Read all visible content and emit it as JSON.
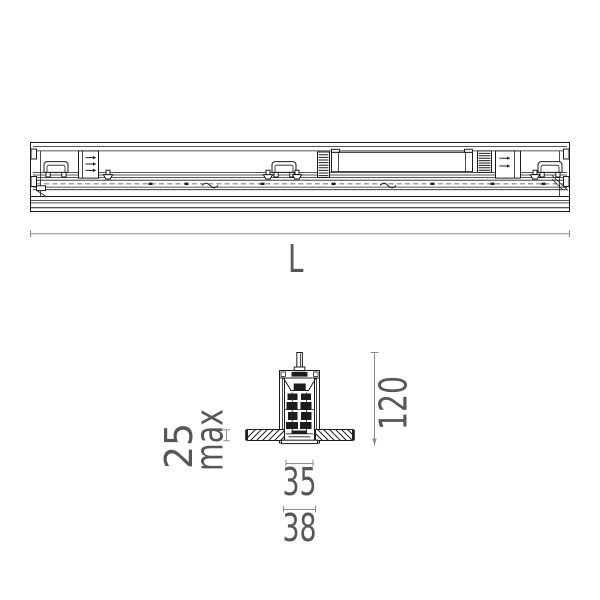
{
  "colors": {
    "background": "#ffffff",
    "drawing_line": "#1d1d1b",
    "dimension_line": "#8c8c8c",
    "dimension_text": "#575756"
  },
  "dimensions": {
    "length_label": "L",
    "fixture_height": "120",
    "ceiling_thickness": "25",
    "ceiling_thickness_qualifier": "max",
    "cutout_width": "35",
    "overall_width": "38"
  }
}
